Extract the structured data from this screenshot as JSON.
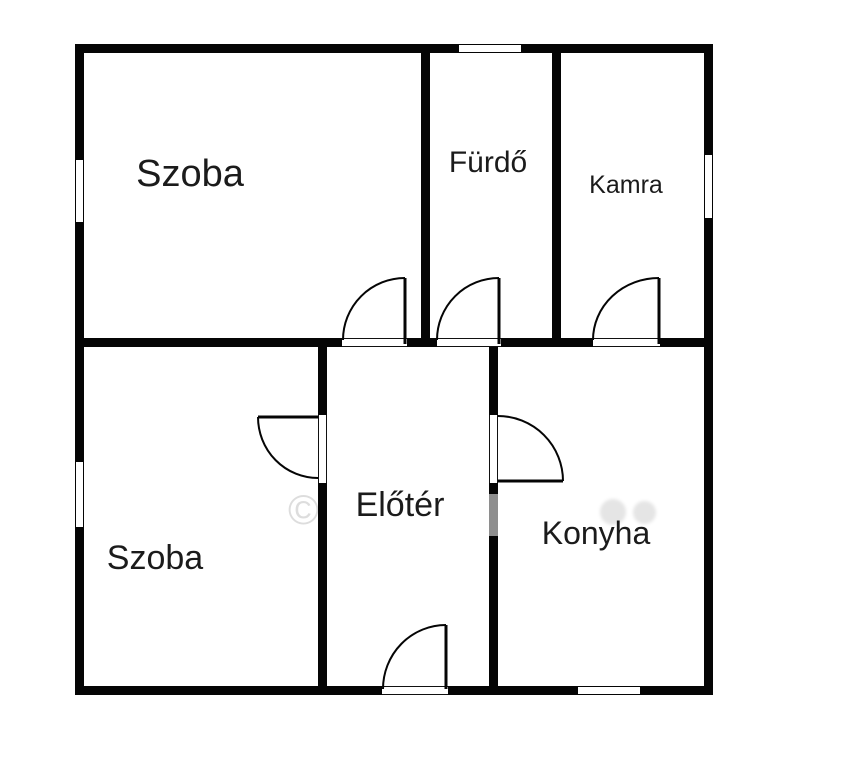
{
  "rooms": [
    {
      "id": "szoba-top",
      "label": "Szoba"
    },
    {
      "id": "furdo",
      "label": "Fürdő"
    },
    {
      "id": "kamra",
      "label": "Kamra"
    },
    {
      "id": "szoba-bottom",
      "label": "Szoba"
    },
    {
      "id": "eloter",
      "label": "Előtér"
    },
    {
      "id": "konyha",
      "label": "Konyha"
    }
  ],
  "watermark": {
    "symbol": "©"
  },
  "colors": {
    "wall": "#050505",
    "background": "#ffffff",
    "label": "#1b1b1b"
  }
}
